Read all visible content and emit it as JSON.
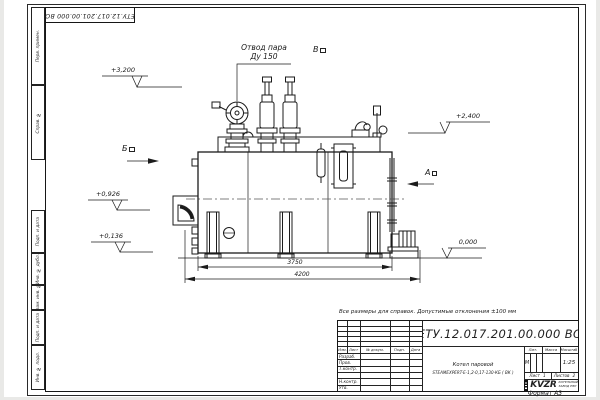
{
  "page": {
    "format_label": "Формат А3"
  },
  "margin": {
    "corner_designation": "ЕТУ.12.017.201.00.000  ВО",
    "labels": [
      "Перв. примен.",
      "Справ. №",
      "Подп. и дата",
      "Инв. № дубл.",
      "Взам. инв. №",
      "Подп. и дата",
      "Инв. № подл."
    ]
  },
  "drawing": {
    "callout_steam_line1": "Отвод пара",
    "callout_steam_line2": "Ду 150",
    "view_markers": {
      "a": "А",
      "b": "Б",
      "v": "В"
    },
    "elevations": {
      "top": "+3,200",
      "right": "+2,400",
      "mid": "+0,926",
      "low": "+0,136",
      "zero": "0,000"
    },
    "dimensions": {
      "inner": "3750",
      "overall": "4200"
    }
  },
  "note": "Все размеры для справок. Допустимые отклонения ±100 мм",
  "title_block": {
    "designation": "ЕТУ.12.017.201.00.000  ВО",
    "product_line1": "Котел паровой",
    "product_line2": "STEAMEXPERT-Е-1,2-0,17-130-КБ ( ВК )",
    "rev_header": [
      "Изм.",
      "Лист",
      "№ докум.",
      "Подп.",
      "Дата"
    ],
    "staff_rows": [
      "Разраб.",
      "Пров.",
      "Т.контр.",
      "",
      "Н.контр.",
      "Утв."
    ],
    "lit_header": "Лит.",
    "mass_header": "Масса",
    "scale_header": "Масштаб",
    "lit_value": "М",
    "scale_value": "1:25",
    "sheet_label": "Лист",
    "sheet_value": "1",
    "sheets_label": "Листов",
    "sheets_value": "2",
    "logo": {
      "text": "KVZR",
      "sub1": "КОТЕЛЬНЫЙ",
      "sub2": "ЗАВОД РЭП"
    }
  }
}
